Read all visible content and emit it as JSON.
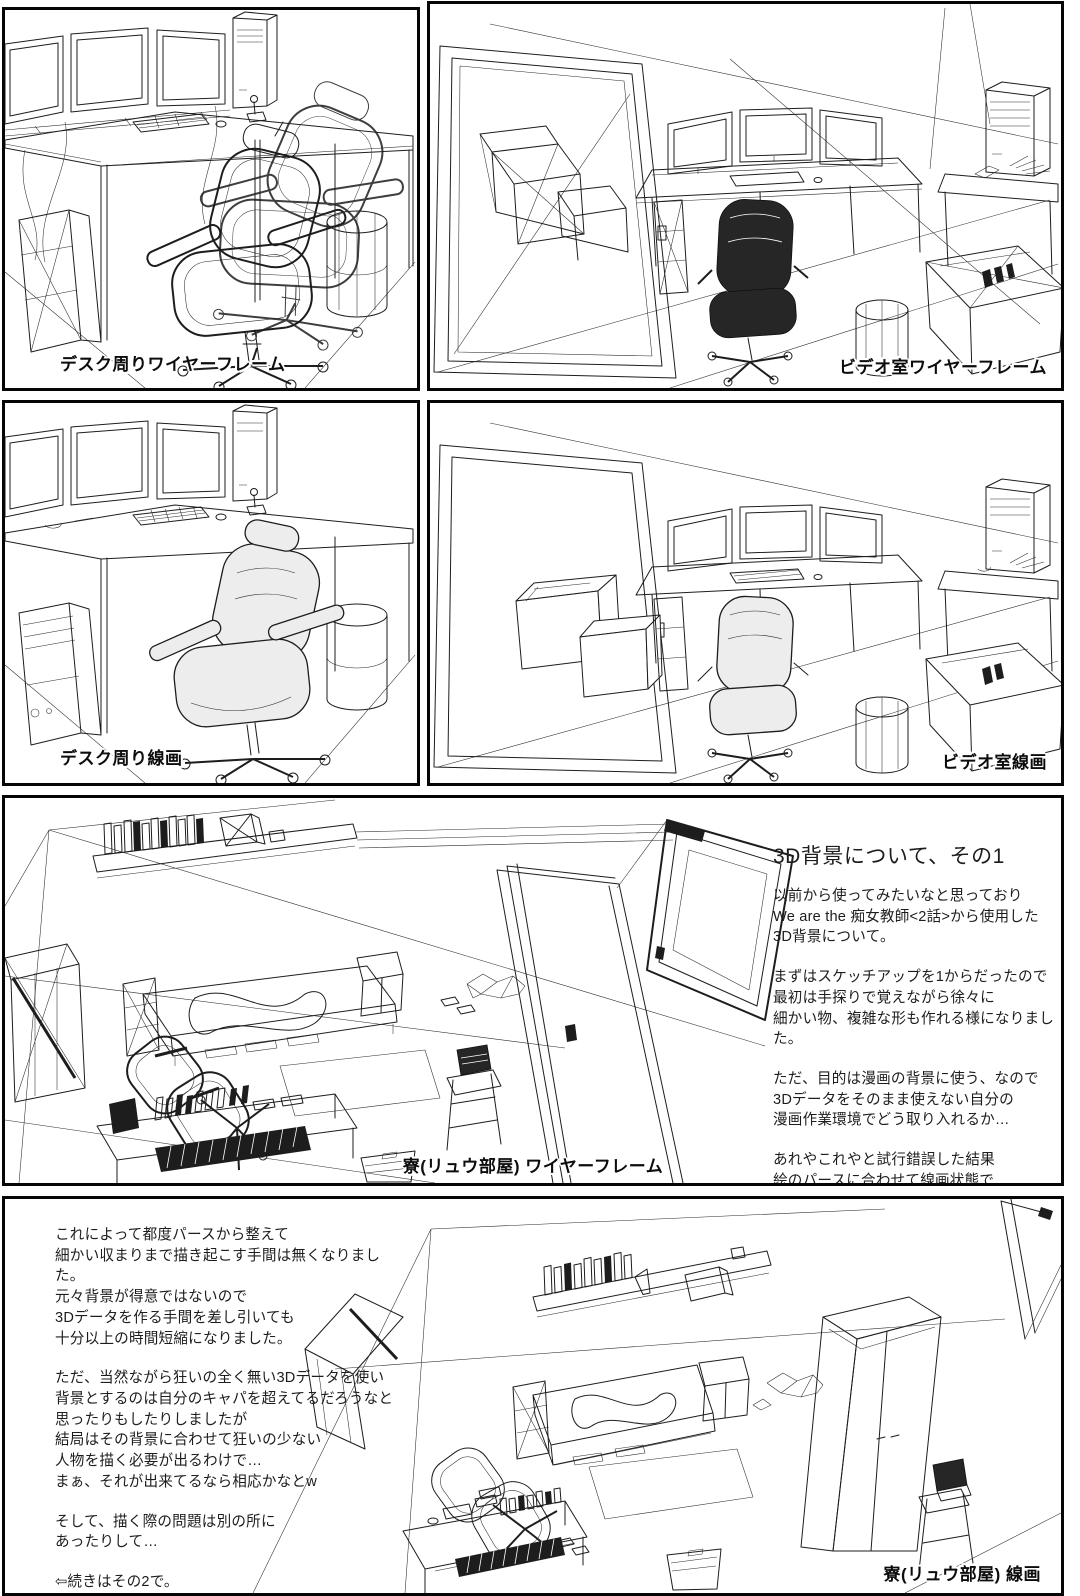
{
  "colors": {
    "paper": "#ffffff",
    "ink": "#1d1d1d",
    "panel_border": "#000000"
  },
  "panels": [
    {
      "label": "デスク周りワイヤーフレーム"
    },
    {
      "label": "ビデオ室ワイヤーフレーム"
    },
    {
      "label": "デスク周り線画"
    },
    {
      "label": "ビデオ室線画"
    },
    {
      "label": "寮(リュウ部屋) ワイヤーフレーム"
    },
    {
      "label": "寮(リュウ部屋) 線画"
    }
  ],
  "article1": {
    "title": "3D背景について、その1",
    "p1": "以前から使ってみたいなと思っており\nWe are the 痴女教師<2話>から使用した\n3D背景について。",
    "p2": "まずはスケッチアップを1からだったので\n最初は手探りで覚えながら徐々に\n細かい物、複雑な形も作れる様になりました。",
    "p3": "ただ、目的は漫画の背景に使う、なので\n3Dデータをそのまま使えない自分の\n漫画作業環境でどう取り入れるか…",
    "p4": "あれやこれやと試行錯誤した結果\n絵のパースに合わせて線画状態で\nレンダリングしたものを張り合わせて\nその線画を活かして加筆修正をする方法に\n落ち着きました。"
  },
  "article2": {
    "p1": "これによって都度パースから整えて\n細かい収まりまで描き起こす手間は無くなりました。\n元々背景が得意ではないので\n3Dデータを作る手間を差し引いても\n十分以上の時間短縮になりました。",
    "p2": "ただ、当然ながら狂いの全く無い3Dデータを使い\n背景とするのは自分のキャパを超えてるだろうなと\n思ったりもしたりしましたが\n結局はその背景に合わせて狂いの少ない\n人物を描く必要が出るわけで…\nまぁ、それが出来てるなら相応かなとw",
    "p3": "そして、描く際の問題は別の所に\nあったりして…",
    "p4": "⇦続きはその2で。"
  }
}
